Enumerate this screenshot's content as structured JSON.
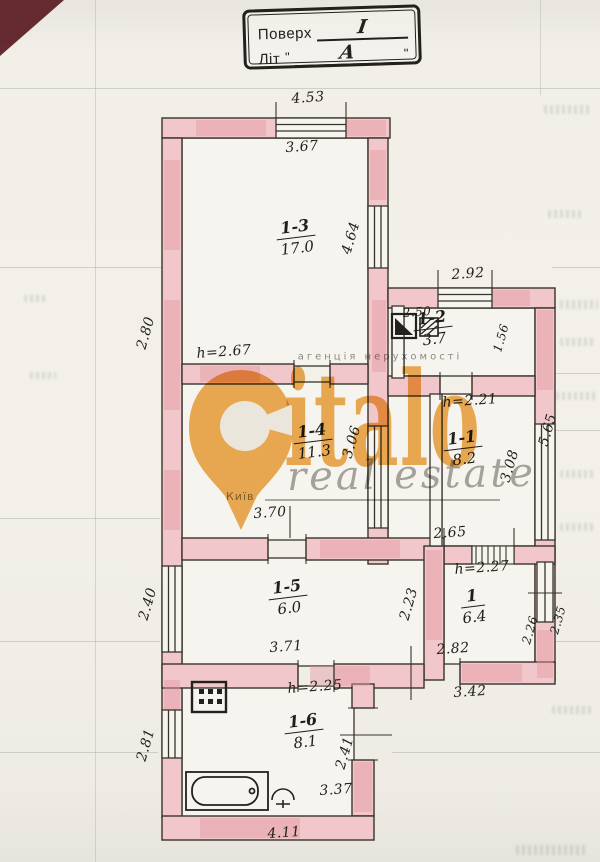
{
  "stamp": {
    "floor_label": "Поверх",
    "floor_value": "I",
    "lit_label": "Літ",
    "lit_quote": "\"",
    "lit_value": "А"
  },
  "watermark": {
    "agency": "агенція нерухомості",
    "brand": "Sitalo",
    "brand_letters": "italo",
    "tagline": "real estate",
    "city": "Київ",
    "accent_color": "#eda43e"
  },
  "rooms": {
    "r13": {
      "id": "1-3",
      "area": "17.0"
    },
    "r12": {
      "id": "1-2",
      "area": "3.7"
    },
    "r14": {
      "id": "1-4",
      "area": "11.3"
    },
    "r11": {
      "id": "1-1",
      "area": "8.2"
    },
    "r15": {
      "id": "1-5",
      "area": "6.0"
    },
    "r1": {
      "id": "1",
      "area": "6.4"
    },
    "r16": {
      "id": "1-6",
      "area": "8.1"
    }
  },
  "dims": {
    "d453": "4.53",
    "d367": "3.67",
    "d464": "4.64",
    "d292": "2.92",
    "d250": "2.50",
    "d156": "1.56",
    "d280": "2.80",
    "h267": "h=2.67",
    "h221": "h=2.21",
    "d565": "5.65",
    "d306": "3.06",
    "d308": "3.08",
    "d370": "3.70",
    "d265": "2.65",
    "h227": "h=2.27",
    "d240": "2.40",
    "d223": "2.23",
    "d371": "3.71",
    "d226": "2.26",
    "d235": "2.35",
    "d282": "2.82",
    "d342": "3.42",
    "h225": "h=2.25",
    "d241": "2.41",
    "d281": "2.81",
    "d337": "3.37",
    "d411": "4.11"
  },
  "colors": {
    "wall_highlight": "#f2c7cb",
    "ink": "#38342c"
  }
}
